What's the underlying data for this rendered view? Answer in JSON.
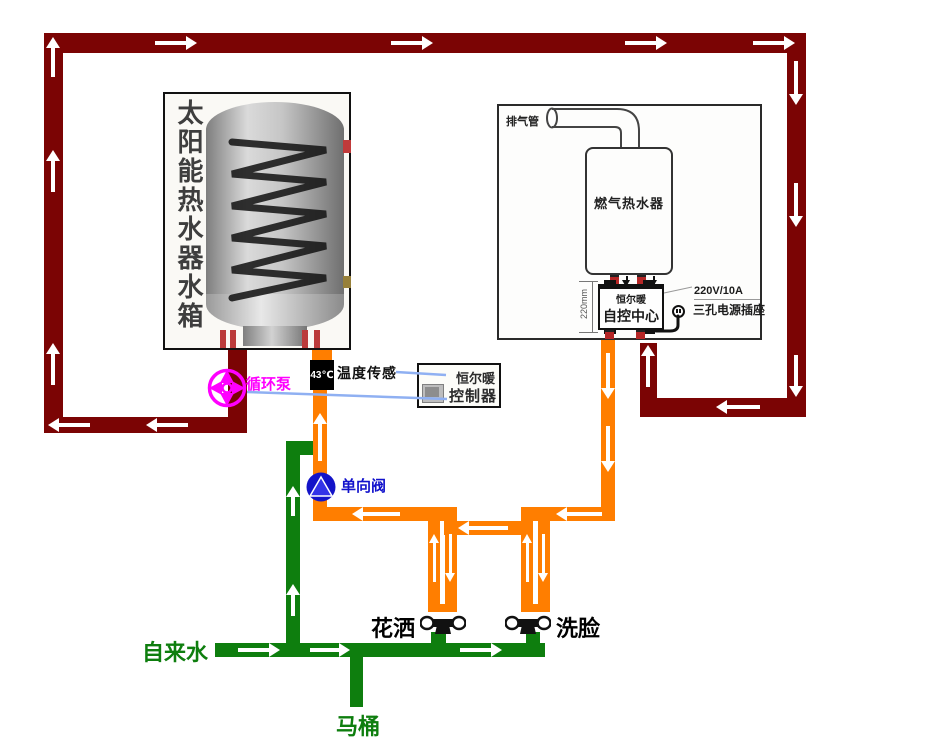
{
  "solar_tank": {
    "label": "太阳能热水器水箱"
  },
  "pump": {
    "label": "循环泵"
  },
  "sensor": {
    "temp": "43℃",
    "label": "温度传感"
  },
  "controller": {
    "brand": "恒尔暖",
    "name": "控制器"
  },
  "check_valve": {
    "label": "单向阀"
  },
  "gas_heater": {
    "exhaust_label": "排气管",
    "name": "燃气热水器",
    "control_center": {
      "brand": "恒尔暖",
      "name": "自控中心"
    },
    "dimension": "220mm",
    "power_rating": "220V/10A",
    "socket_label": "三孔电源插座"
  },
  "water_points": {
    "tap": "自来水",
    "toilet": "马桶",
    "shower": "花洒",
    "basin": "洗脸"
  },
  "colors": {
    "solar_loop_pipe": "#7b0404",
    "hot_water_pipe": "#ff7e00",
    "cold_water_pipe": "#0e7e0e",
    "pump_accent": "#ff00ff",
    "valve_accent": "#1414c8",
    "signal_line": "#8fb0f2"
  },
  "icons": {
    "pump-icon": "magenta impeller wheel",
    "check-valve-icon": "blue circle with upward triangle",
    "temperature-sensor-icon": "black box reading 43℃",
    "faucet-icon": "black tap with two white handles",
    "power-plug-icon": "round plug with cord",
    "flow-arrow-icon": "white flow-direction arrow"
  }
}
